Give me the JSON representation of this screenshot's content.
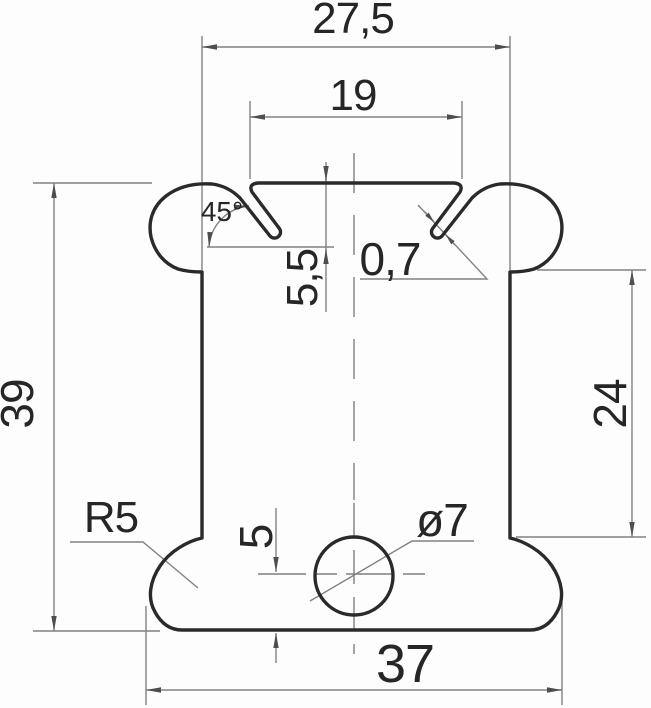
{
  "page": {
    "background": "#fdfdfd",
    "kind": "technical drawing of a profile cross-section"
  },
  "drawing": {
    "colors": {
      "profile_stroke": "#2a2a2a",
      "dimension_stroke": "#828282",
      "arrow_fill": "#4e4e4e",
      "text_fill": "#262626"
    },
    "dimensions": {
      "top_width": "27,5",
      "slot_width": "19",
      "flange_angle": "45°",
      "flange_depth": "5,5",
      "material_thickness": "0,7",
      "overall_height": "39",
      "side_height": "24",
      "corner_radius": "R5",
      "hole_offset": "5",
      "hole_diameter": "ø7",
      "bottom_width": "37"
    }
  }
}
